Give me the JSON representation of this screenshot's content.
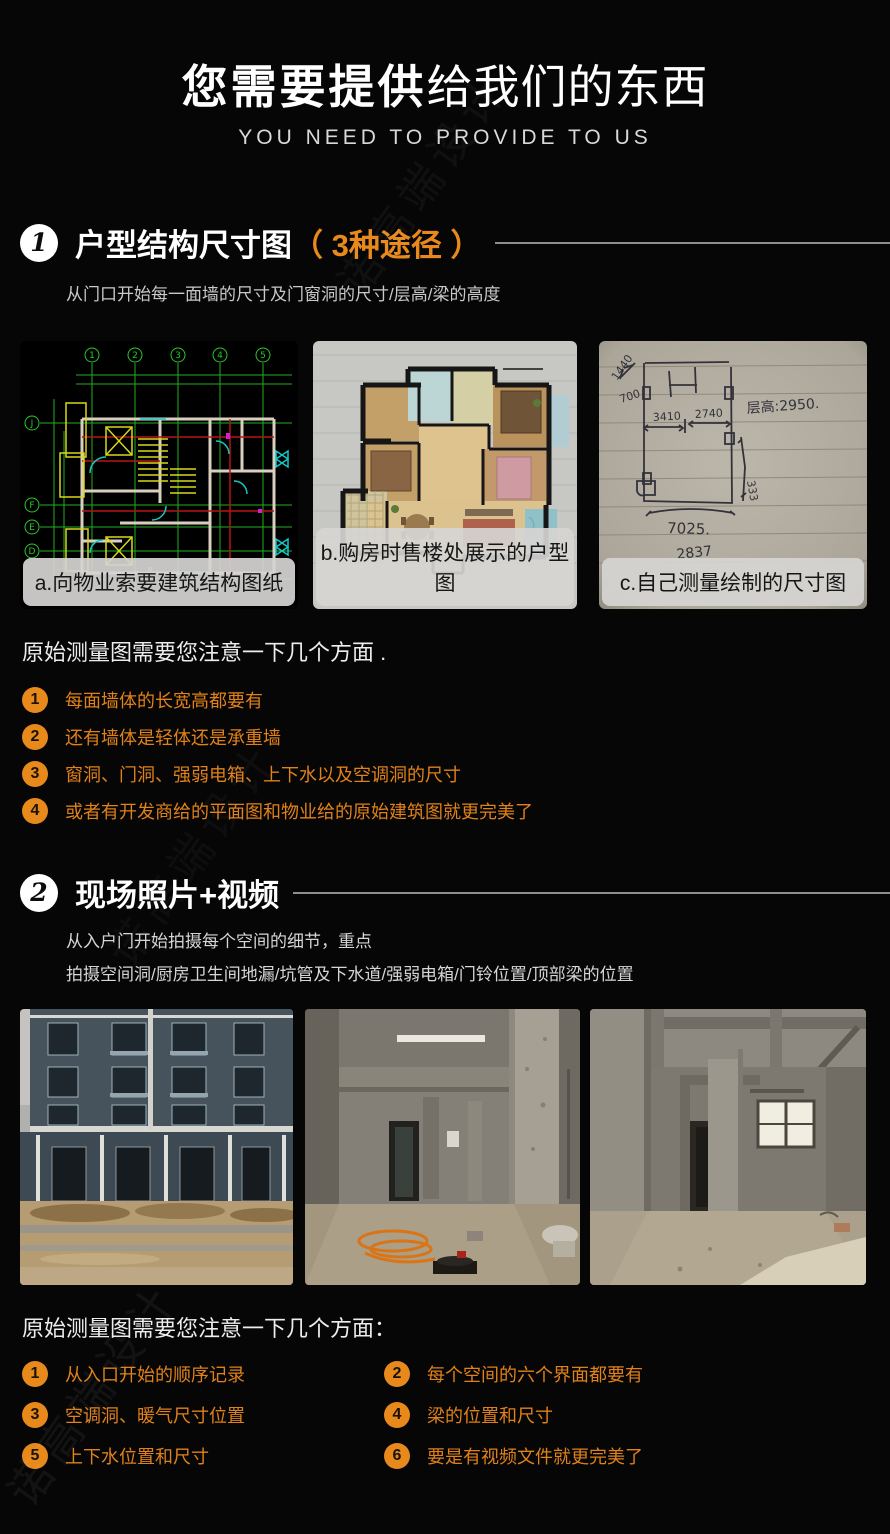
{
  "colors": {
    "accent": "#e8891c",
    "badge_white": "#ffffff",
    "background": "#060606"
  },
  "page": {
    "title_strong": "您需要提供",
    "title_rest": "给我们的东西",
    "subtitle": "YOU NEED TO PROVIDE TO US"
  },
  "watermark": "诺高端设计",
  "section1": {
    "number": "1",
    "title": "户型结构尺寸图",
    "title_accent": "（ 3种途径 ）",
    "description": "从门口开始每一面墙的尺寸及门窗洞的尺寸/层高/梁的高度",
    "figures": [
      {
        "kind": "cad-blueprint",
        "caption": "a.向物业索要建筑结构图纸"
      },
      {
        "kind": "color-floorplan",
        "caption": "b.购房时售楼处展示的户型图"
      },
      {
        "kind": "hand-sketch",
        "caption": "c.自己测量绘制的尺寸图"
      }
    ],
    "note": "原始测量图需要您注意一下几个方面 .",
    "points": [
      {
        "num": "1",
        "text": "每面墙体的长宽高都要有"
      },
      {
        "num": "2",
        "text": "还有墙体是轻体还是承重墙"
      },
      {
        "num": "3",
        "text": "窗洞、门洞、强弱电箱、上下水以及空调洞的尺寸"
      },
      {
        "num": "4",
        "text": "或者有开发商给的平面图和物业给的原始建筑图就更完美了"
      }
    ]
  },
  "section2": {
    "number": "2",
    "title": "现场照片+视频",
    "description_line1": "从入户门开始拍摄每个空间的细节，重点",
    "description_line2": "拍摄空间洞/厨房卫生间地漏/坑管及下水道/强弱电箱/门铃位置/顶部梁的位置",
    "note": "原始测量图需要您注意一下几个方面：",
    "points": [
      {
        "num": "1",
        "text": "从入口开始的顺序记录"
      },
      {
        "num": "2",
        "text": "每个空间的六个界面都要有"
      },
      {
        "num": "3",
        "text": "空调洞、暖气尺寸位置"
      },
      {
        "num": "4",
        "text": "梁的位置和尺寸"
      },
      {
        "num": "5",
        "text": "上下水位置和尺寸"
      },
      {
        "num": "6",
        "text": "要是有视频文件就更完美了"
      }
    ]
  },
  "cad": {
    "cols": [
      "1",
      "2",
      "3",
      "4",
      "5"
    ],
    "rows": [
      "J",
      "F",
      "E",
      "D"
    ]
  },
  "sketch": {
    "ceiling_height": "层高:2950.",
    "width_total": "7025.",
    "width_bottom": "2837",
    "dim_a": "3410",
    "dim_b": "2740",
    "dim_c": "333",
    "dim_d": "1440",
    "dim_e": "700"
  }
}
